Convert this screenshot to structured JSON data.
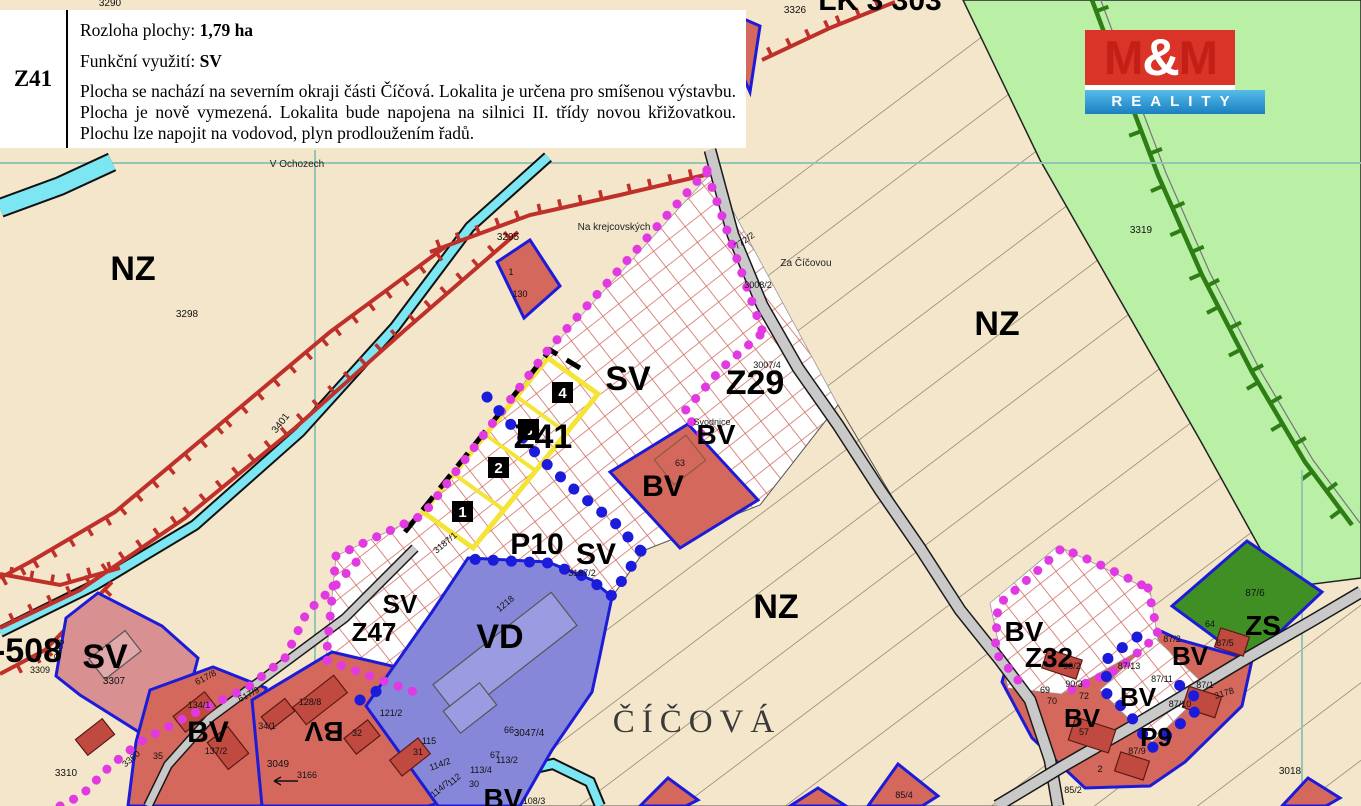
{
  "info_box": {
    "code": "Z41",
    "rows": [
      {
        "label": "Rozloha plochy:",
        "value": "1,79 ha"
      },
      {
        "label": "Funkční využití:",
        "value": "SV"
      }
    ],
    "description": "Plocha se nachází na severním okraji části Číčová. Lokalita je určena pro smíšenou výstavbu. Plocha je nově vymezená. Lokalita bude napojena na silnici II. třídy novou křižovatkou. Plochu lze napojit na vodovod, plyn prodloužením řadů."
  },
  "logo": {
    "m_left": "M",
    "amp": "&",
    "m_right": "M",
    "subtitle": "REALITY",
    "red": "#da3428",
    "blue": "#1a7fc2"
  },
  "map": {
    "colors": {
      "background": "#f4e6cb",
      "green_area": "#b9f0a6",
      "railway": "#2e7d15",
      "hatch_grid": "#d06a60",
      "bv_fill": "#d5685c",
      "sv_fill": "#d89090",
      "vd_fill": "#8787da",
      "zs_fill": "#3f8f25",
      "road": "#c9c9c9",
      "stream": "#7ce7f2",
      "boundary_magenta": "#e23ae2",
      "boundary_blue": "#1b1bdc",
      "plot_outline": "#1c1cd8",
      "yellow_plot": "#f4e435"
    },
    "labels": [
      {
        "kind": "zone",
        "text": "NZ",
        "x": 133,
        "y": 280,
        "size": 34
      },
      {
        "kind": "zone",
        "text": "NZ",
        "x": 997,
        "y": 335,
        "size": 34
      },
      {
        "kind": "zone",
        "text": "NZ",
        "x": 776,
        "y": 618,
        "size": 34
      },
      {
        "kind": "zone",
        "text": "SV",
        "x": 628,
        "y": 390,
        "size": 34
      },
      {
        "kind": "zone",
        "text": "Z29",
        "x": 755,
        "y": 394,
        "size": 34
      },
      {
        "kind": "zone",
        "text": "Z41",
        "x": 543,
        "y": 448,
        "size": 34
      },
      {
        "kind": "zone",
        "text": "BV",
        "x": 716,
        "y": 444,
        "size": 28
      },
      {
        "kind": "zone",
        "text": "BV",
        "x": 663,
        "y": 496,
        "size": 30
      },
      {
        "kind": "zone",
        "text": "P10",
        "x": 537,
        "y": 554,
        "size": 30
      },
      {
        "kind": "zone",
        "text": "SV",
        "x": 596,
        "y": 564,
        "size": 30
      },
      {
        "kind": "zone",
        "text": "SV",
        "x": 400,
        "y": 613,
        "size": 26
      },
      {
        "kind": "zone",
        "text": "Z47",
        "x": 374,
        "y": 641,
        "size": 26
      },
      {
        "kind": "zone",
        "text": "VD",
        "x": 500,
        "y": 648,
        "size": 34
      },
      {
        "kind": "zone",
        "text": "SV",
        "x": 105,
        "y": 668,
        "size": 34
      },
      {
        "kind": "zone",
        "text": "-508",
        "x": 28,
        "y": 662,
        "size": 34
      },
      {
        "kind": "zone",
        "text": "BV",
        "x": 208,
        "y": 742,
        "size": 30
      },
      {
        "kind": "zone",
        "text": "BV",
        "x": 324,
        "y": 722,
        "size": 28,
        "rot": 180
      },
      {
        "kind": "zone",
        "text": "BV",
        "x": 503,
        "y": 808,
        "size": 28
      },
      {
        "kind": "zone",
        "text": "BV",
        "x": 1024,
        "y": 641,
        "size": 28
      },
      {
        "kind": "zone",
        "text": "Z32",
        "x": 1049,
        "y": 667,
        "size": 28
      },
      {
        "kind": "zone",
        "text": "BV",
        "x": 1190,
        "y": 665,
        "size": 26
      },
      {
        "kind": "zone",
        "text": "BV",
        "x": 1138,
        "y": 706,
        "size": 26
      },
      {
        "kind": "zone",
        "text": "BV",
        "x": 1082,
        "y": 727,
        "size": 26
      },
      {
        "kind": "zone",
        "text": "P9",
        "x": 1156,
        "y": 746,
        "size": 26
      },
      {
        "kind": "zone",
        "text": "ZS",
        "x": 1263,
        "y": 635,
        "size": 28
      },
      {
        "kind": "zone",
        "text": "LK 3 303",
        "x": 880,
        "y": 10,
        "size": 30
      },
      {
        "kind": "town",
        "text": "ČÍČOVÁ",
        "x": 697,
        "y": 732,
        "size": 33
      },
      {
        "kind": "place",
        "text": "V Ochozech",
        "x": 297,
        "y": 167,
        "size": 10
      },
      {
        "kind": "place",
        "text": "Na krejcovských",
        "x": 614,
        "y": 230,
        "size": 10
      },
      {
        "kind": "place",
        "text": "Za Číčovou",
        "x": 806,
        "y": 266,
        "size": 10
      },
      {
        "kind": "place",
        "text": "Svodnice",
        "x": 712,
        "y": 425,
        "size": 9
      },
      {
        "kind": "parcel",
        "text": "3290",
        "x": 110,
        "y": 6,
        "size": 10
      },
      {
        "kind": "parcel",
        "text": "3298",
        "x": 187,
        "y": 317,
        "size": 10
      },
      {
        "kind": "parcel",
        "text": "3295",
        "x": 508,
        "y": 240,
        "size": 10
      },
      {
        "kind": "parcel",
        "text": "1",
        "x": 511,
        "y": 275,
        "size": 9
      },
      {
        "kind": "parcel",
        "text": "130",
        "x": 520,
        "y": 297,
        "size": 9
      },
      {
        "kind": "parcel",
        "text": "3326",
        "x": 795,
        "y": 13,
        "size": 10
      },
      {
        "kind": "parcel",
        "text": "3401",
        "x": 283,
        "y": 425,
        "size": 10,
        "rot": -52
      },
      {
        "kind": "parcel",
        "text": "3319",
        "x": 1141,
        "y": 233,
        "size": 10
      },
      {
        "kind": "parcel",
        "text": "772/2",
        "x": 746,
        "y": 243,
        "size": 9,
        "rot": -35
      },
      {
        "kind": "parcel",
        "text": "3008/2",
        "x": 758,
        "y": 288,
        "size": 9
      },
      {
        "kind": "parcel",
        "text": "3007/4",
        "x": 767,
        "y": 368,
        "size": 9
      },
      {
        "kind": "parcel",
        "text": "3187/1",
        "x": 447,
        "y": 545,
        "size": 9,
        "rot": -40
      },
      {
        "kind": "parcel",
        "text": "3187/2",
        "x": 582,
        "y": 576,
        "size": 9
      },
      {
        "kind": "parcel",
        "text": "1218",
        "x": 507,
        "y": 606,
        "size": 9,
        "rot": -40
      },
      {
        "kind": "parcel",
        "text": "63",
        "x": 680,
        "y": 466,
        "size": 9
      },
      {
        "kind": "parcel",
        "text": "3307",
        "x": 114,
        "y": 684,
        "size": 10
      },
      {
        "kind": "parcel",
        "text": "3308",
        "x": 62,
        "y": 650,
        "size": 9,
        "rot": -75
      },
      {
        "kind": "parcel",
        "text": "3309",
        "x": 40,
        "y": 673,
        "size": 9
      },
      {
        "kind": "parcel",
        "text": "3310",
        "x": 66,
        "y": 776,
        "size": 10
      },
      {
        "kind": "parcel",
        "text": "3360",
        "x": 133,
        "y": 761,
        "size": 9,
        "rot": -40
      },
      {
        "kind": "parcel",
        "text": "134/1",
        "x": 199,
        "y": 708,
        "size": 9
      },
      {
        "kind": "parcel",
        "text": "34/1",
        "x": 267,
        "y": 729,
        "size": 9
      },
      {
        "kind": "parcel",
        "text": "137/2",
        "x": 216,
        "y": 754,
        "size": 9
      },
      {
        "kind": "parcel",
        "text": "35",
        "x": 158,
        "y": 759,
        "size": 9
      },
      {
        "kind": "parcel",
        "text": "617/9",
        "x": 250,
        "y": 697,
        "size": 9,
        "rot": -28
      },
      {
        "kind": "parcel",
        "text": "617/8",
        "x": 207,
        "y": 680,
        "size": 9,
        "rot": -28
      },
      {
        "kind": "parcel",
        "text": "3049",
        "x": 278,
        "y": 767,
        "size": 10
      },
      {
        "kind": "parcel",
        "text": "3166",
        "x": 307,
        "y": 778,
        "size": 9
      },
      {
        "kind": "parcel",
        "text": "128/8",
        "x": 310,
        "y": 705,
        "size": 9
      },
      {
        "kind": "parcel",
        "text": "121/2",
        "x": 391,
        "y": 716,
        "size": 9
      },
      {
        "kind": "parcel",
        "text": "32",
        "x": 357,
        "y": 736,
        "size": 9
      },
      {
        "kind": "parcel",
        "text": "115",
        "x": 429,
        "y": 744,
        "size": 9
      },
      {
        "kind": "parcel",
        "text": "31",
        "x": 418,
        "y": 755,
        "size": 9
      },
      {
        "kind": "parcel",
        "text": "114/2",
        "x": 441,
        "y": 767,
        "size": 9,
        "rot": -20
      },
      {
        "kind": "parcel",
        "text": "112",
        "x": 456,
        "y": 782,
        "size": 9,
        "rot": -40
      },
      {
        "kind": "parcel",
        "text": "114/7",
        "x": 442,
        "y": 791,
        "size": 9,
        "rot": -40
      },
      {
        "kind": "parcel",
        "text": "30",
        "x": 474,
        "y": 787,
        "size": 9
      },
      {
        "kind": "parcel",
        "text": "113/4",
        "x": 481,
        "y": 773,
        "size": 9
      },
      {
        "kind": "parcel",
        "text": "113/2",
        "x": 507,
        "y": 763,
        "size": 9
      },
      {
        "kind": "parcel",
        "text": "67",
        "x": 495,
        "y": 758,
        "size": 9
      },
      {
        "kind": "parcel",
        "text": "66",
        "x": 509,
        "y": 733,
        "size": 9
      },
      {
        "kind": "parcel",
        "text": "3047/4",
        "x": 529,
        "y": 736,
        "size": 10
      },
      {
        "kind": "parcel",
        "text": "108/3",
        "x": 534,
        "y": 804,
        "size": 9
      },
      {
        "kind": "parcel",
        "text": "90/2",
        "x": 1072,
        "y": 669,
        "size": 9
      },
      {
        "kind": "parcel",
        "text": "90/3",
        "x": 1074,
        "y": 687,
        "size": 9
      },
      {
        "kind": "parcel",
        "text": "69",
        "x": 1045,
        "y": 693,
        "size": 9
      },
      {
        "kind": "parcel",
        "text": "70",
        "x": 1052,
        "y": 704,
        "size": 9
      },
      {
        "kind": "parcel",
        "text": "72",
        "x": 1084,
        "y": 699,
        "size": 9
      },
      {
        "kind": "parcel",
        "text": "57",
        "x": 1084,
        "y": 735,
        "size": 9
      },
      {
        "kind": "parcel",
        "text": "2",
        "x": 1100,
        "y": 772,
        "size": 9
      },
      {
        "kind": "parcel",
        "text": "87/13",
        "x": 1129,
        "y": 669,
        "size": 9
      },
      {
        "kind": "parcel",
        "text": "87/11",
        "x": 1162,
        "y": 682,
        "size": 9
      },
      {
        "kind": "parcel",
        "text": "87/2",
        "x": 1172,
        "y": 642,
        "size": 9
      },
      {
        "kind": "parcel",
        "text": "64",
        "x": 1210,
        "y": 627,
        "size": 9
      },
      {
        "kind": "parcel",
        "text": "87/5",
        "x": 1225,
        "y": 646,
        "size": 9
      },
      {
        "kind": "parcel",
        "text": "87/6",
        "x": 1255,
        "y": 596,
        "size": 10
      },
      {
        "kind": "parcel",
        "text": "87/1",
        "x": 1205,
        "y": 688,
        "size": 9
      },
      {
        "kind": "parcel",
        "text": "3178",
        "x": 1225,
        "y": 696,
        "size": 9,
        "rot": -18
      },
      {
        "kind": "parcel",
        "text": "87/10",
        "x": 1180,
        "y": 707,
        "size": 9
      },
      {
        "kind": "parcel",
        "text": "87/9",
        "x": 1137,
        "y": 754,
        "size": 9
      },
      {
        "kind": "parcel",
        "text": "3018",
        "x": 1290,
        "y": 774,
        "size": 10
      },
      {
        "kind": "parcel",
        "text": "85/2",
        "x": 1073,
        "y": 793,
        "size": 9
      },
      {
        "kind": "parcel",
        "text": "85/4",
        "x": 904,
        "y": 798,
        "size": 9
      }
    ],
    "plot_markers": [
      {
        "n": "1",
        "x": 462,
        "y": 512
      },
      {
        "n": "2",
        "x": 498,
        "y": 468
      },
      {
        "n": "3",
        "x": 528,
        "y": 430
      },
      {
        "n": "4",
        "x": 562,
        "y": 393
      }
    ]
  }
}
